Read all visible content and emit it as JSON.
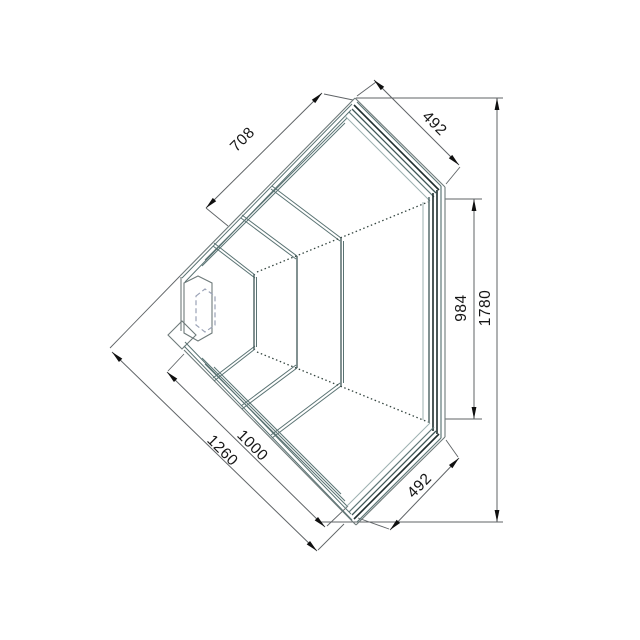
{
  "drawing": {
    "dimensions": [
      {
        "id": "front-top-glass-length",
        "label": "708"
      },
      {
        "id": "top-right-side-width",
        "label": "492"
      },
      {
        "id": "right-inner-length",
        "label": "984"
      },
      {
        "id": "right-overall-length",
        "label": "1780"
      },
      {
        "id": "front-bottom-inner-length",
        "label": "1000"
      },
      {
        "id": "front-bottom-outer-length",
        "label": "1260"
      },
      {
        "id": "bottom-right-side-width",
        "label": "492"
      }
    ],
    "colors": {
      "background": "#ffffff",
      "dim_line": "#5f6366",
      "arrow": "#101010",
      "text": "#161616",
      "edge": "#6e7a7a",
      "glass_dark": "#1f2d2d",
      "glass_mid": "#3e5656",
      "glass_soft": "#5f7878",
      "glass_light": "#9db1b1",
      "rail": "#5a7373",
      "hidden_dash": "#9aa2b6",
      "dotted": "#33443f"
    }
  }
}
